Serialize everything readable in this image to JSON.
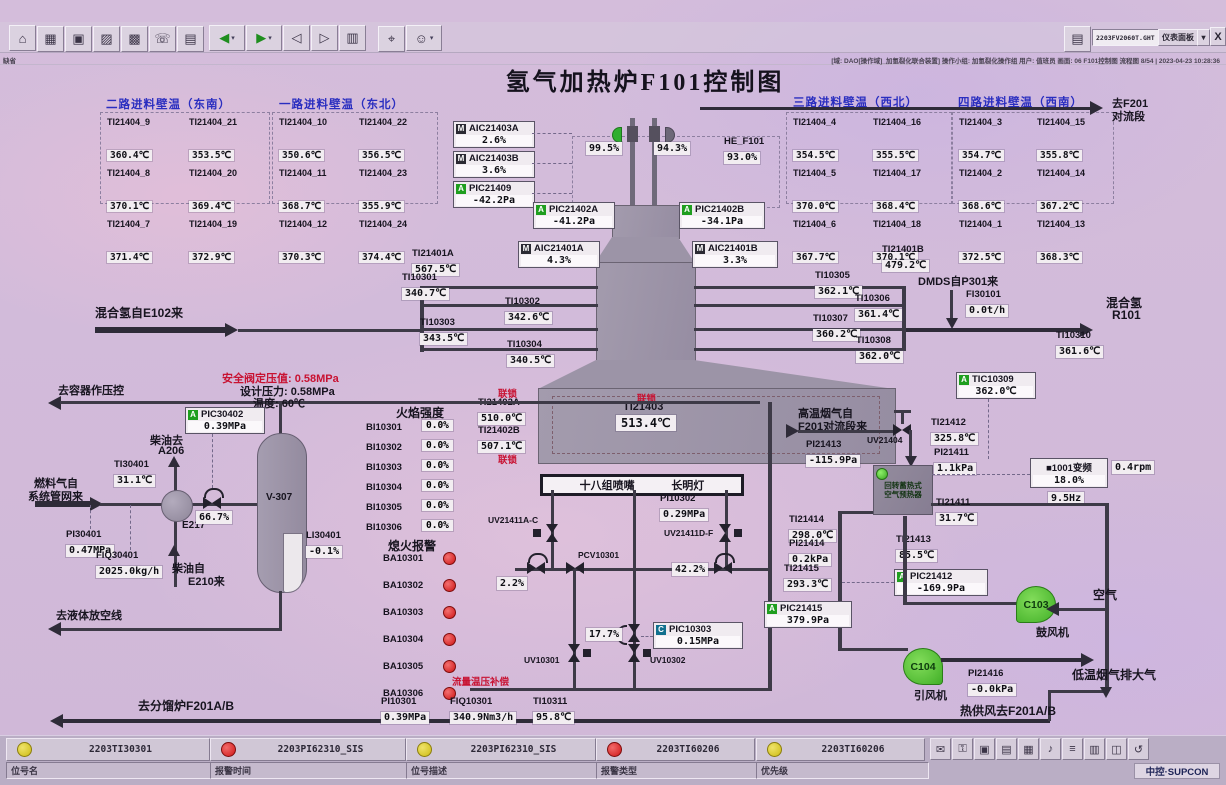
{
  "window": {
    "doc": "2203FV2060T.GHT",
    "panel": "仪表面板",
    "dd": "▾",
    "close": "X",
    "status_left": "缺省",
    "status_right": "[域: DAO[操作域]_加氢裂化联合装置] 操作小组: 加氢裂化操作组  用户: 值班员  画面: 06 F101控制图  流程图 8/54 | 2023-04-23 10:28:36"
  },
  "title": "氢气加热炉F101控制图",
  "toolbar": {
    "main": [
      {
        "n": "home-icon",
        "g": "⌂"
      },
      {
        "n": "table-icon",
        "g": "▦"
      },
      {
        "n": "monitor-icon",
        "g": "▣"
      },
      {
        "n": "trend-icon",
        "g": "▨"
      },
      {
        "n": "grid-icon",
        "g": "▩"
      },
      {
        "n": "phone-icon",
        "g": "☏"
      },
      {
        "n": "document-icon",
        "g": "▤"
      }
    ],
    "nav": [
      {
        "n": "back-icon",
        "g": "◀",
        "dd": true
      },
      {
        "n": "forward-icon",
        "g": "▶",
        "dd": true
      },
      {
        "n": "page-prev-icon",
        "g": "◁"
      },
      {
        "n": "page-next-icon",
        "g": "▷"
      },
      {
        "n": "book-icon",
        "g": "▥"
      }
    ],
    "tools": [
      {
        "n": "search-icon",
        "g": "⌖"
      },
      {
        "n": "user-icon",
        "g": "☺",
        "dd": true
      }
    ],
    "print": {
      "n": "printer-icon",
      "g": "▤"
    }
  },
  "tray": [
    {
      "n": "mouse-icon",
      "g": "✉"
    },
    {
      "n": "lock-icon",
      "g": "⚿"
    },
    {
      "n": "screen-icon",
      "g": "▣"
    },
    {
      "n": "printer2-icon",
      "g": "▤"
    },
    {
      "n": "calendar-icon",
      "g": "▦"
    },
    {
      "n": "alarm-bell-icon",
      "g": "♪"
    },
    {
      "n": "list-icon",
      "g": "≡"
    },
    {
      "n": "report-icon",
      "g": "▥"
    },
    {
      "n": "window-icon",
      "g": "◫"
    },
    {
      "n": "help-icon",
      "g": "↺"
    }
  ],
  "walls": [
    {
      "title": "二路进料壁温（东南）",
      "items": [
        [
          "TI21404_9",
          "360.4℃"
        ],
        [
          "TI21404_21",
          "353.5℃"
        ],
        [
          "TI21404_8",
          "370.1℃"
        ],
        [
          "TI21404_20",
          "369.4℃"
        ],
        [
          "TI21404_7",
          "371.4℃"
        ],
        [
          "TI21404_19",
          "372.9℃"
        ]
      ]
    },
    {
      "title": "一路进料壁温（东北）",
      "items": [
        [
          "TI21404_10",
          "350.6℃"
        ],
        [
          "TI21404_22",
          "356.5℃"
        ],
        [
          "TI21404_11",
          "368.7℃"
        ],
        [
          "TI21404_23",
          "355.9℃"
        ],
        [
          "TI21404_12",
          "370.3℃"
        ],
        [
          "TI21404_24",
          "374.4℃"
        ]
      ]
    },
    {
      "title": "三路进料壁温（西北）",
      "items": [
        [
          "TI21404_4",
          "354.5℃"
        ],
        [
          "TI21404_16",
          "355.5℃"
        ],
        [
          "TI21404_5",
          "370.0℃"
        ],
        [
          "TI21404_17",
          "368.4℃"
        ],
        [
          "TI21404_6",
          "367.7℃"
        ],
        [
          "TI21404_18",
          "370.1℃"
        ]
      ]
    },
    {
      "title": "四路进料壁温（西南）",
      "items": [
        [
          "TI21404_3",
          "354.7℃"
        ],
        [
          "TI21404_15",
          "355.8℃"
        ],
        [
          "TI21404_2",
          "368.6℃"
        ],
        [
          "TI21404_14",
          "367.2℃"
        ],
        [
          "TI21404_1",
          "372.5℃"
        ],
        [
          "TI21404_13",
          "368.3℃"
        ]
      ]
    }
  ],
  "r": {
    "TI21401A": [
      "TI21401A",
      "567.5℃"
    ],
    "TI10301": [
      "TI10301",
      "340.7℃"
    ],
    "TI10302": [
      "TI10302",
      "342.6℃"
    ],
    "TI10303": [
      "TI10303",
      "343.5℃"
    ],
    "TI10304": [
      "TI10304",
      "340.5℃"
    ],
    "TI21401B": [
      "TI21401B",
      "479.2℃"
    ],
    "TI10305": [
      "TI10305",
      "362.1℃"
    ],
    "TI10306": [
      "TI10306",
      "361.4℃"
    ],
    "TI10307": [
      "TI10307",
      "360.2℃"
    ],
    "TI10308": [
      "TI10308",
      "362.0℃"
    ],
    "FI30101": [
      "FI30101",
      "0.0t/h"
    ],
    "TI10310": [
      "TI10310",
      "361.6℃"
    ],
    "TI21402A": [
      "TI21402A",
      "510.0℃"
    ],
    "TI21402B": [
      "TI21402B",
      "507.1℃"
    ],
    "PI10302": [
      "PI10302",
      "0.29MPa"
    ],
    "TI30401": [
      "TI30401",
      "31.1℃"
    ],
    "PI30401": [
      "PI30401",
      "0.47MPa"
    ],
    "FIQ30401": [
      "FIQ30401",
      "2025.0kg/h"
    ],
    "LI30401": [
      "LI30401",
      "-0.1%"
    ],
    "PI10301": [
      "PI10301",
      "0.39MPa"
    ],
    "FIQ10301": [
      "FIQ10301",
      "340.9Nm3/h"
    ],
    "TI10311": [
      "TI10311",
      "95.8℃"
    ],
    "TI21412": [
      "TI21412",
      "325.8℃"
    ],
    "PI21413": [
      "PI21413",
      "-115.9Pa"
    ],
    "PI21411": [
      "PI21411",
      "1.1kPa"
    ],
    "TI21411": [
      "TI21411",
      "31.7℃"
    ],
    "TI21414": [
      "TI21414",
      "298.0℃"
    ],
    "PI21414": [
      "PI21414",
      "0.2kPa"
    ],
    "TI21413": [
      "TI21413",
      "85.5℃"
    ],
    "TI21415": [
      "TI21415",
      "293.3℃"
    ],
    "PI21416": [
      "PI21416",
      "-0.0kPa"
    ],
    "HE_F101": [
      "HE_F101",
      "93.0%"
    ]
  },
  "big": {
    "tag": "TI21403",
    "value": "513.4℃"
  },
  "pv": {
    "v99": "99.5%",
    "v94": "94.3%",
    "v66": "66.7%",
    "v22": "2.2%",
    "v42": "42.2%",
    "v17": "17.7%"
  },
  "vfd": {
    "name": "■1001变频",
    "pct": "18.0%",
    "hz": "9.5Hz",
    "rpm": "0.4rpm"
  },
  "c": {
    "AIC21403A": [
      "M",
      "AIC21403A",
      "2.6%"
    ],
    "AIC21403B": [
      "M",
      "AIC21403B",
      "3.6%"
    ],
    "PIC21409": [
      "A",
      "PIC21409",
      "-42.2Pa"
    ],
    "PIC21402A": [
      "A",
      "PIC21402A",
      "-41.2Pa"
    ],
    "PIC21402B": [
      "A",
      "PIC21402B",
      "-34.1Pa"
    ],
    "AIC21401A": [
      "M",
      "AIC21401A",
      "4.3%"
    ],
    "AIC21401B": [
      "M",
      "AIC21401B",
      "3.3%"
    ],
    "PIC30402": [
      "A",
      "PIC30402",
      "0.39MPa"
    ],
    "TIC10309": [
      "A",
      "TIC10309",
      "362.0℃"
    ],
    "PIC10303": [
      "C",
      "PIC10303",
      "0.15MPa"
    ],
    "PIC21412": [
      "A",
      "PIC21412",
      "-169.9Pa"
    ],
    "PIC21415": [
      "A",
      "PIC21415",
      "379.9Pa"
    ]
  },
  "flame": {
    "header": "火焰强度",
    "items": [
      [
        "BI10301",
        "0.0%"
      ],
      [
        "BI10302",
        "0.0%"
      ],
      [
        "BI10303",
        "0.0%"
      ],
      [
        "BI10304",
        "0.0%"
      ],
      [
        "BI10305",
        "0.0%"
      ],
      [
        "BI10306",
        "0.0%"
      ]
    ]
  },
  "ba": {
    "header": "熄火报警",
    "items": [
      "BA10301",
      "BA10302",
      "BA10303",
      "BA10304",
      "BA10305",
      "BA10306"
    ]
  },
  "L": {
    "toF201a": "去F201",
    "toF201b": "对流段",
    "mixedH2In": "混合氢自E102来",
    "dmds": "DMDS自P301来",
    "mixedH2a": "混合氢",
    "mixedH2b": "R101",
    "toVessel": "去容器作压控",
    "safety": "安全阀定压值: 0.58MPa",
    "design": "设计压力: 0.58MPa",
    "temp60": "温度: 60℃",
    "dieselToA": "柴油去",
    "dieselToB": "A206",
    "fuelGasA": "燃料气自",
    "fuelGasB": "系统管网来",
    "e217": "E217",
    "v307": "V-307",
    "dieselFromA": "柴油自",
    "dieselFromB": "E210来",
    "toLiquidVent": "去液体放空线",
    "toF201AB": "去分馏炉F201A/B",
    "burners": "十八组喷嘴",
    "pilot": "长明灯",
    "interlock": "联锁",
    "flowComp": "流量温压补偿",
    "hotAir": "热供风去F201A/B",
    "hotFlueA": "高温烟气自",
    "hotFlueB": "F201对流段来",
    "preheatA": "回转蓄热式",
    "preheatB": "空气预热器",
    "air": "空气",
    "blower": "鼓风机",
    "inducedFan": "引风机",
    "lowFlue": "低温烟气排大气",
    "c103": "C103",
    "c104": "C104",
    "he": "HE_F101",
    "uv21411ac": "UV21411A-C",
    "uv21411df": "UV21411D-F",
    "pcv10301": "PCV10301",
    "uv10301": "UV10301",
    "uv10302": "UV10302",
    "uv21404": "UV21404"
  },
  "alarms": [
    {
      "c": "y",
      "tag": "2203TI30301"
    },
    {
      "c": "r",
      "tag": "2203PI62310_SIS"
    },
    {
      "c": "y",
      "tag": "2203PI62310_SIS"
    },
    {
      "c": "r",
      "tag": "2203TI60206"
    },
    {
      "c": "y",
      "tag": "2203TI60206"
    }
  ],
  "fields": [
    "位号名",
    "报警时间",
    "位号描述",
    "报警类型",
    "优先级"
  ],
  "logo": "中控·SUPCON"
}
